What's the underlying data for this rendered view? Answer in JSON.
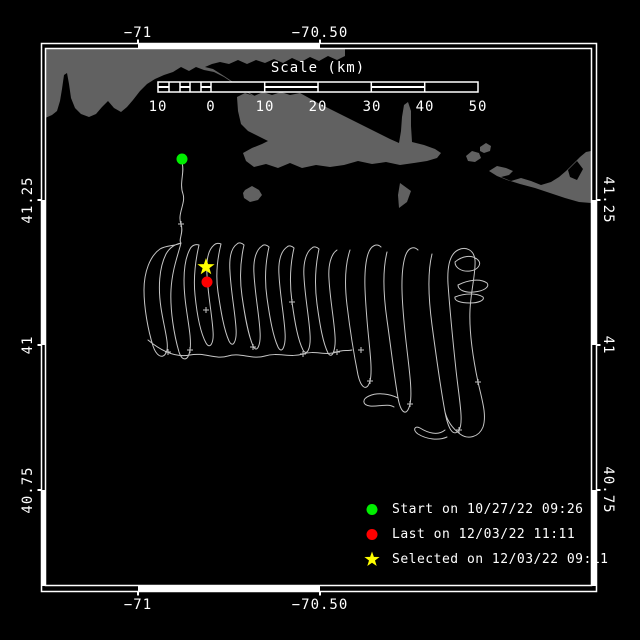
{
  "colors": {
    "background": "#000000",
    "frame": "#ffffff",
    "land": "#616161",
    "track": "#c6c6c6",
    "start": "#00ee00",
    "last": "#ff0000",
    "selected": "#ffff00"
  },
  "map": {
    "x_axis_labels": [
      "−71",
      "−70.50"
    ],
    "y_axis_labels": [
      "41.25",
      "41",
      "40.75"
    ],
    "scale_bar": {
      "title": "Scale (km)",
      "tick_labels": [
        "10",
        "0",
        "10",
        "20",
        "30",
        "40",
        "50"
      ]
    },
    "land_paths": {
      "mainland": "M45,49 L345,49 L345,56 L337,60 L328,56 L319,61 L310,57 L301,62 L292,58 L283,63 L274,59 L265,63 L256,60 L247,64 L238,60 L229,64 L220,62 L212,64 L205,67 L213,69 L224,76 L236,84 L248,92 L260,99 L271,104 L280,108 L288,110 L283,112 L272,107 L260,100 L248,93 L236,85 L224,77 L214,72 L204,70 L196,67 L189,71 L181,67 L173,72 L164,75 L155,79 L147,84 L140,91 L133,100 L127,107 L121,112 L114,108 L108,101 L102,107 L96,114 L89,117 L81,114 L75,108 L71,98 L69,84 L67,73 L64,75 L62,89 L60,101 L57,111 L52,115 L45,118 Z",
      "marthas_vineyard": "M237,97 L245,93 L254,96 L263,92 L272,95 L281,92 L290,95 L300,93 L309,98 L318,103 L330,109 L342,115 L354,121 L366,127 L378,133 L390,139 L399,143 L401,131 L402,117 L404,105 L408,102 L411,111 L411,126 L412,142 L424,145 L435,149 L441,153 L437,158 L427,161 L414,163 L400,165 L386,162 L372,164 L358,161 L344,165 L330,167 L316,165 L302,168 L290,163 L278,168 L266,164 L254,167 L246,161 L243,153 L252,148 L262,144 L268,141 L258,136 L248,131 L241,124 L238,111 Z",
      "nomans_land": "M245,190 L252,186 L259,190 L262,195 L258,200 L250,202 L244,198 L243,193 Z",
      "wasque_shoal": "M400,183 L411,191 L407,202 L399,208 L398,195 Z",
      "tuckernuck": "M466,156 L472,151 L479,153 L481,158 L475,162 L468,161 Z",
      "muskeget": "M480,147 L486,143 L491,146 L490,151 L484,153 L480,151 Z",
      "nantucket": "M489,171 L497,166 L506,168 L513,171 L509,175 L501,177 L511,181 L521,178 L531,181 L541,185 L551,182 L559,177 L566,171 L573,164 L580,157 L586,152 L591,151 L591,203 L579,202 L565,198 L550,193 L535,188 L520,184 L507,180 L497,176 Z",
      "nantucket_notch": "M568,170 L577,161 L583,169 L577,180 L570,177 Z"
    },
    "track_path": "M182,163 C185,172 179,183 183,194 C186,203 177,214 181,224 C184,233 178,240 181,243 C176,246 166,245 160,249 C150,256 144,272 144,290 C144,308 148,330 153,346 C156,355 162,360 166,353 C170,346 164,328 161,308 C158,288 159,268 166,254 C170,247 176,244 181,243 C178,255 172,270 171,290 C170,310 174,335 179,352 C182,361 188,362 190,350 C192,338 187,318 185,298 C183,278 184,260 190,249 C192,245 196,244 199,245 C196,258 193,275 195,295 C197,315 200,332 206,343 C210,350 214,343 213,331 C212,315 208,295 207,275 C206,260 208,250 214,245 C216,243 219,243 221,244 C218,256 215,272 218,292 C221,312 224,330 229,341 C233,349 237,341 236,328 C235,312 231,292 230,272 C229,258 231,248 237,244 C239,242 242,243 244,245 C241,258 239,275 242,296 C245,317 248,334 253,346 C257,354 261,345 260,331 C259,314 255,294 254,274 C253,260 256,250 262,246 C264,244 267,245 269,247 C266,260 264,277 267,298 C270,319 273,336 278,347 C282,355 286,346 285,332 C284,315 280,295 279,275 C278,261 281,251 287,247 C289,245 292,246 294,248 C291,261 289,280 292,302 C295,324 298,340 303,350 C307,357 311,348 310,334 C309,317 305,297 304,277 C303,263 306,252 312,248 C314,246 317,247 319,249 C316,263 314,282 317,304 C320,326 323,343 328,353 C332,360 336,350 335,336 C334,319 330,299 329,279 C328,265 331,254 337,250 M148,340 C160,350 175,358 190,355 C205,352 215,360 228,356 C240,352 252,360 265,356 C278,352 290,358 303,354 C315,350 325,356 337,352 C342,350 347,351 352,350 M350,250 C346,262 344,280 347,305 C350,330 354,355 358,375 C361,388 367,392 370,381 C373,370 369,345 367,320 C365,295 363,270 368,254 C371,245 377,243 381,247 M387,252 C383,268 383,292 387,320 C391,348 394,375 398,398 C401,414 407,417 410,404 C413,391 408,362 405,332 C402,302 400,274 405,257 C408,247 414,246 418,250 M432,254 C428,270 428,295 432,325 C436,355 440,385 445,412 C448,428 453,438 459,430 C464,423 459,398 456,370 C453,342 450,312 448,284 C447,266 450,254 458,250 C466,246 474,250 475,260 C476,272 471,290 470,310 C469,332 473,358 478,382 C482,400 487,415 483,427 C479,437 468,440 460,434 C452,428 447,420 445,412 M455,262 C462,256 472,254 478,260 C482,264 478,270 470,271 C462,272 455,268 455,262 M458,285 C468,280 480,278 487,283 C490,287 484,291 474,292 C465,293 458,290 458,285 M455,297 C465,293 477,293 483,297 C485,300 479,303 470,303 C461,303 454,301 455,297 M445,430 C438,436 428,433 420,428 C415,425 412,430 418,434 C426,439 438,441 447,437 M398,398 C390,394 378,392 369,396 C362,399 362,405 370,406 C378,407 388,403 394,407",
    "track_points_path": "M165,352 L171,352 M168,349 L168,355 M187,350 L193,350 M190,347 L190,353 M250,347 L256,347 M253,344 L253,350 M300,354 L306,354 M303,351 L303,357 M334,352 L340,352 M337,349 L337,355 M203,310 L209,310 M206,307 L206,313 M289,302 L295,302 M292,299 L292,305 M367,381 L373,381 M370,378 L370,384 M407,404 L413,404 M410,401 L410,407 M456,430 L462,430 M459,427 L459,433 M475,382 L481,382 M478,379 L478,385 M178,224 L184,224 M181,221 L181,227 M358,350 L364,350 M361,347 L361,353",
    "markers": {
      "start": {
        "color": "#00ee00",
        "path": "M176.5,159 a5.5,5.5 0 1,0 11,0 a5.5,5.5 0 1,0 -11,0 Z"
      },
      "last": {
        "color": "#ff0000",
        "path": "M201.5,282 a5.5,5.5 0 1,0 11,0 a5.5,5.5 0 1,0 -11,0 Z"
      },
      "selected": {
        "color": "#ffff00",
        "path": "M206,258 L208.1,264.1 L214.6,264.2 L209.4,268.1 L211.3,274.3 L206,270.6 L200.7,274.3 L202.6,268.1 L197.4,264.2 L203.9,264.1 Z"
      }
    }
  },
  "legend": {
    "items": [
      {
        "marker": "circle",
        "color": "#00ee00",
        "label": "Start on 10/27/22 09:26"
      },
      {
        "marker": "circle",
        "color": "#ff0000",
        "label": "Last on 12/03/22 11:11"
      },
      {
        "marker": "star",
        "color": "#ffff00",
        "label": "Selected on 12/03/22 09:11"
      }
    ]
  }
}
